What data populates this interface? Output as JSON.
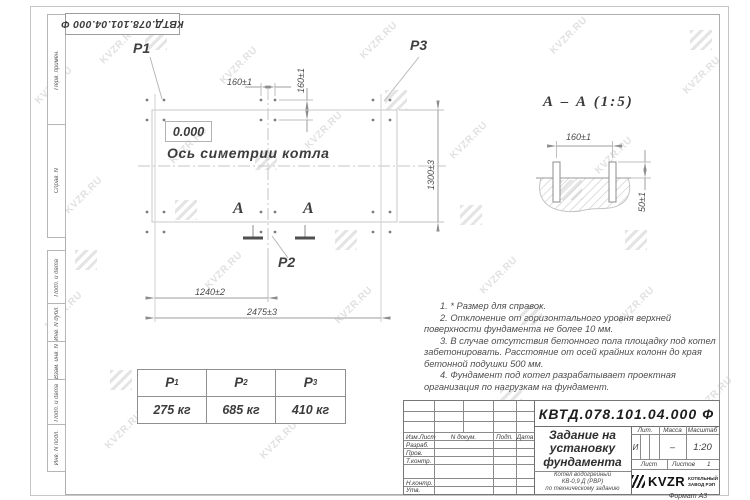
{
  "watermark": {
    "text": "KVZR.RU"
  },
  "corner_stamp": {
    "doc_number": "КВТД.078.101.04.000 Ф"
  },
  "margin_labels": {
    "items": [
      "Перв. примен.",
      "Справ. N",
      "Подп. и дата",
      "Инв. N дубл.",
      "Взам. инв. N",
      "Подп. и дата",
      "Инв. N подл."
    ]
  },
  "plan": {
    "p1": "P1",
    "p2": "P2",
    "p3": "P3",
    "level": "0.000",
    "axis_label": "Ось симетрии котла",
    "dim_160h": "160±1",
    "dim_160v": "160±1",
    "dim_1300": "1300±3",
    "dim_1240": "1240±2",
    "dim_2475": "2475±3",
    "section_letter": "А"
  },
  "section": {
    "title": "А – А (1:5)",
    "dim_160": "160±1",
    "dim_50": "50±1"
  },
  "notes": {
    "n1": "1. * Размер для справок.",
    "n2": "2. Отклонение от горизонтального уровня верхней поверхности фундамента не более 10 мм.",
    "n3": "3. В случае отсутствия бетонного пола площадку под котел забетонировать. Расстояние от осей крайних колонн до края бетонной подушки 500 мм.",
    "n4": "4. Фундамент под котел разрабатывает проектная организация по нагрузкам на фундамент."
  },
  "load_table": {
    "h1": "P",
    "h1s": "1",
    "h2": "P",
    "h2s": "2",
    "h3": "P",
    "h3s": "3",
    "v1": "275 кг",
    "v2": "685 кг",
    "v3": "410 кг"
  },
  "title_block": {
    "doc_number": "КВТД.078.101.04.000 Ф",
    "title1": "Задание на",
    "title2": "установку",
    "title3": "фундамента",
    "sub1": "Котел водогрейный",
    "sub2": "КВ-0,9 Д (РВР)",
    "sub3": "по техническому заданию",
    "col_izm": "Изм.Лист",
    "col_doc": "N докум.",
    "col_sign": "Подп.",
    "col_date": "Дата",
    "row_razrab": "Разраб.",
    "row_prov": "Пров.",
    "row_tkontr": "Т.контр.",
    "row_nkontr": "Н.контр.",
    "row_utv": "Утв.",
    "lit_h": "Лит.",
    "mass_h": "Масса",
    "scale_h": "Масштаб",
    "lit_v": "И",
    "mass_v": "–",
    "scale_v": "1:20",
    "sheet_h": "Лист",
    "sheets_h": "Листов",
    "sheets_v": "1",
    "logo": "KVZR",
    "logo_cap1": "КОТЕЛЬНЫЙ",
    "logo_cap2": "ЗАВОД РЭП",
    "format": "Формат А3"
  }
}
